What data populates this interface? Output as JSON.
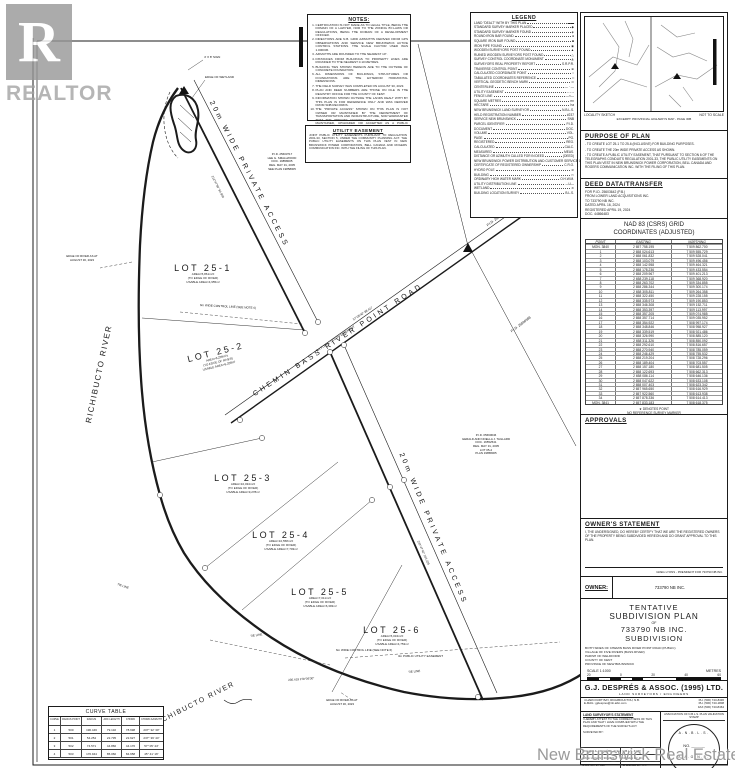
{
  "sheet": {
    "watermark_logo_letter": "R",
    "watermark_logo_text": "REALTOR",
    "watermark_board_text": "New Brunswick Real Estate Board"
  },
  "notes": {
    "title": "NOTES:",
    "items": [
      "CERTIFICATION IS NOT MADE AS TO LEGAL TITLE, BEING THE DOMAIN OF A LAWYER, NOR TO THE ZONING BY-LAWS OR REGULATIONS, BEING THE DOMAIN OF A DEVELOPMENT OFFICER.",
      "DIRECTIONS ARE N.B. GRID AZIMUTHS DERIVED FROM GPS OBSERVATIONS AND SERVICE NEW BRUNSWICK ACTIVE CONTROL STATIONS. THE SCALE FACTOR USED WAS 1.000036.",
      "AZIMUTHS ARE ROUNDED TO THE NEAREST 10\".",
      "DISTANCES FROM BUILDINGS TO PROPERTY LINES ARE ROUNDED TO THE NEAREST 0.10 METRES.",
      "BUILDING TIES SHOWN HEREON ARE TO THE OUTSIDE OF CONCRETE FOUNDATION.",
      "ALL DIMENSIONS OF BUILDINGS, STRUCTURES OR FOUNDATIONS ARE THE EXTERIOR HORIZONTAL DIMENSIONS.",
      "THE FIELD SURVEY WAS COMPLETED ON AUGUST 30, 2023.",
      "PLAN AND DEED NUMBERS ARE THOSE ON FILE IN THE REGISTRY OFFICE FOR THE COUNTY OF KENT.",
      "INFORMATION SHOWN OUTSIDE THE LANDS DEALT WITH BY THIS PLAN IS FOR REFERENCE ONLY AND WAS DERIVED FROM SNB RECORDS.",
      "THE \"PRIVATE ACCESS\" SHOWN ON THIS PLAN IS NOT OWNED OR MAINTAINED BY THE DEPARTMENT OF TRANSPORTATION AND INFRASTRUCTURE, NOR WARRANTED THAT THE \"PRIVATE ACCESS\" WILL IN THE FUTURE BE MAINTAINED, UPGRADED OR ACCEPTED AS A PUBLIC STREET.",
      "SUBJECT TO WATERCOURSE ALTERATION REGULATION 90-80 UNDER THE CLEAN WATER ACT (O.C. 90-532)."
    ]
  },
  "utility_easement": {
    "title": "UTILITY EASEMENT",
    "body": "JOINT PUBLIC UTILITY EASEMENTS PURSUANT TO REGULATION 2001-33, SECTION 5, UNDER THE COMMUNITY PLANNING ACT. THE PUBLIC UTILITY EASEMENTS ON THIS PLAN VEST IN NEW BRUNSWICK POWER CORPORATION, BELL CANADA AND ROGERS COMMUNICATION INC. WITH THE FILING OF THIS PLAN."
  },
  "legend": {
    "title": "LEGEND",
    "items": [
      {
        "label": "LAND \"DEALT\" WITH BY THIS PLAN",
        "symbol": "▬▬"
      },
      {
        "label": "STANDARD SURVEY MARKER PLACED",
        "symbol": "◆"
      },
      {
        "label": "STANDARD SURVEY MARKER FOUND",
        "symbol": "◈"
      },
      {
        "label": "ROUND IRON BAR FOUND",
        "symbol": "●"
      },
      {
        "label": "SQUARE IRON BAR FOUND",
        "symbol": "■"
      },
      {
        "label": "IRON PIPE FOUND",
        "symbol": "◉"
      },
      {
        "label": "WOODEN SURVEYORS POST FOUND",
        "symbol": "▲"
      },
      {
        "label": "RUINED WOODEN SURVEYORS POST FOUND",
        "symbol": "△"
      },
      {
        "label": "SURVEY CONTROL COORDINATE MONUMENT",
        "symbol": "◭"
      },
      {
        "label": "SURVEYOR'S REAL PROPERTY REPORT",
        "symbol": "S.R.P.R."
      },
      {
        "label": "TRAVERSE CONTROL POINT",
        "symbol": "⊕"
      },
      {
        "label": "CALCULATED COORDINATE POINT",
        "symbol": "○"
      },
      {
        "label": "TABULATED COORDINATES REFERENCE",
        "symbol": "□"
      },
      {
        "label": "VERTICAL GEODETIC BENCH MARK",
        "symbol": "⊙"
      },
      {
        "label": "CENTERLINE",
        "symbol": "— · —"
      },
      {
        "label": "UTILITY EASEMENT",
        "symbol": "– – –"
      },
      {
        "label": "FENCE LINE",
        "symbol": "—×—"
      },
      {
        "label": "SQUARE METRES",
        "symbol": "m²"
      },
      {
        "label": "HECTARE",
        "symbol": "ha"
      },
      {
        "label": "NEW BRUNSWICK LAND SURVEYOR",
        "symbol": "N.B.L.S."
      },
      {
        "label": "HELD REGISTRATION NUMBER",
        "symbol": "#237"
      },
      {
        "label": "SERVICE NEW BRUNSWICK",
        "symbol": "SNB"
      },
      {
        "label": "PARCEL IDENTIFIER",
        "symbol": "P.I.D."
      },
      {
        "label": "DOCUMENT",
        "symbol": "DOC."
      },
      {
        "label": "VOLUME",
        "symbol": "VOL."
      },
      {
        "label": "PAGE",
        "symbol": "PG."
      },
      {
        "label": "REGISTERED",
        "symbol": "REG."
      },
      {
        "label": "CALCULATED",
        "symbol": "CALC."
      },
      {
        "label": "MEASURED",
        "symbol": "MEAS."
      },
      {
        "label": "DISTANCE OR AZIMUTH CALLED FOR IN DEED",
        "symbol": "(DEED)"
      },
      {
        "label": "NEW BRUNSWICK POWER DISTRIBUTION AND CUSTOMER SERVICE CORPORATION",
        "symbol": "NB POWER"
      },
      {
        "label": "CERTIFICATE OF REGISTERED OWNERSHIP",
        "symbol": "C.R.O."
      },
      {
        "label": "HYDRO POLE",
        "symbol": "⊘"
      },
      {
        "label": "BUILDING",
        "symbol": "▭"
      },
      {
        "label": "ORDINARY HIGH WATER MARK",
        "symbol": "O.H.W.M."
      },
      {
        "label": "UTILITY DISTRIBUTION LINE",
        "symbol": "—U—"
      },
      {
        "label": "WETLAND",
        "symbol": "≋"
      },
      {
        "label": "BUILDING LOCATION SURVEY",
        "symbol": "B.L.S."
      }
    ]
  },
  "locality": {
    "caption_left": "LOCALITY SKETCH",
    "caption_right": "NOT TO SCALE",
    "caption_bottom": "EXCERPT: PROVINCIAL HIGHWAYS MAP - PAGE 30B"
  },
  "purpose": {
    "title": "PURPOSE OF PLAN",
    "items": [
      "TO CREATE LOT 25-1 TO 25-6 (INCLUSIVE) FOR BUILDING PURPOSES.",
      "TO CREATE THE 20m WIDE PRIVATE ACCESS AS SHOWN.",
      "TO CREATE A PUBLIC UTILITY EASEMENT, THAT PURSUANT TO SECTION 6 OF THE TELEGRAPHS CONDUITS REGULATION 2001-33, THE PUBLIC UTILITY EASEMENTS ON THIS PLAN VEST IN NEW BRUNSWICK POWER CORPORATION, BELL CANADA AND ROGERS COMMUNICATION INC. WITH THE FILING OF THIS PLAN."
    ]
  },
  "deed": {
    "title": "DEED DATA/TRANSFER",
    "lines": [
      "FOR P.I.D. 25603642 (P.B.)",
      "FROM LOWER LAND ACQUISITIONS INC.",
      "TO 733790 NB INC.",
      "DATED APRIL 16, 2024",
      "REGISTERED APRIL 19, 2024",
      "DOC. 44866483"
    ]
  },
  "coordinates": {
    "title1": "NAD 83 (CSRS) GRID",
    "title2": "COORDINATES (ADJUSTED)",
    "headers": [
      "POINT",
      "EASTING",
      "NORTHING"
    ],
    "rows": [
      [
        "MON. 3840",
        "2 657 758.195",
        "7 509 862.700"
      ],
      [
        "1",
        "2 658 024.613",
        "7 509 555.729"
      ],
      [
        "2",
        "2 658 061.832",
        "7 509 528.041"
      ],
      [
        "3",
        "2 658 103.079",
        "7 509 496.456"
      ],
      [
        "4",
        "2 658 142.958",
        "7 509 464.321"
      ],
      [
        "5",
        "2 658 178.236",
        "7 509 433.554"
      ],
      [
        "6",
        "2 658 209.967",
        "7 509 401.213"
      ],
      [
        "7",
        "2 658 239.118",
        "7 509 368.920"
      ],
      [
        "8",
        "2 658 263.702",
        "7 509 334.855"
      ],
      [
        "9",
        "2 658 286.344",
        "7 509 300.174"
      ],
      [
        "10",
        "2 658 305.811",
        "7 509 264.358"
      ],
      [
        "11",
        "2 658 322.450",
        "7 509 228.155"
      ],
      [
        "12",
        "2 658 335.973",
        "7 509 190.853"
      ],
      [
        "13",
        "2 658 346.308",
        "7 509 152.711"
      ],
      [
        "14",
        "2 658 353.397",
        "7 509 113.997"
      ],
      [
        "15",
        "2 658 357.205",
        "7 509 074.985"
      ],
      [
        "16",
        "2 658 357.714",
        "7 509 035.952"
      ],
      [
        "17",
        "2 658 354.922",
        "7 508 997.174"
      ],
      [
        "18",
        "2 658 348.846",
        "7 508 958.927"
      ],
      [
        "19",
        "2 658 339.519",
        "7 508 921.486"
      ],
      [
        "20",
        "2 658 326.990",
        "7 508 885.120"
      ],
      [
        "21",
        "2 658 311.326",
        "7 508 850.092"
      ],
      [
        "22",
        "2 658 292.610",
        "7 508 816.657"
      ],
      [
        "23",
        "2 658 270.940",
        "7 508 785.059"
      ],
      [
        "24",
        "2 658 246.429",
        "7 508 755.532"
      ],
      [
        "25",
        "2 658 219.204",
        "7 508 728.296"
      ],
      [
        "26",
        "2 658 189.404",
        "7 508 703.557"
      ],
      [
        "27",
        "2 658 157.180",
        "7 508 681.505"
      ],
      [
        "28",
        "2 658 122.693",
        "7 508 662.313"
      ],
      [
        "29",
        "2 658 086.114",
        "7 508 646.136"
      ],
      [
        "30",
        "2 658 047.622",
        "7 508 633.108"
      ],
      [
        "31",
        "2 658 007.403",
        "7 508 623.342"
      ],
      [
        "32",
        "2 657 965.650",
        "7 508 616.929"
      ],
      [
        "33",
        "2 657 922.560",
        "7 508 613.938"
      ],
      [
        "34",
        "2 657 878.336",
        "7 508 614.413"
      ],
      [
        "MON. 3841",
        "2 657 833.183",
        "7 508 618.375"
      ]
    ],
    "footnote1": "★ DENOTES POINT",
    "footnote2": "NO REFERENCE SURVEY MARKER"
  },
  "approvals": {
    "title": "APPROVALS"
  },
  "owner_statement": {
    "title": "OWNER'S STATEMENT",
    "body": "I, THE UNDERSIGNED, DO HEREBY CERTIFY THAT WE ARE THE REGISTERED OWNERS OF THE PROPERTY BEING SUBDIVIDED HEREON AND DO GRANT APPROVAL TO THIS PLAN.",
    "signature_caption": "GREG LYONS - PRESIDENT FOR 733790 NB INC."
  },
  "owner": {
    "label": "OWNER:",
    "value": "733790 NB INC."
  },
  "title_block": {
    "t1": "TENTATIVE",
    "t2": "SUBDIVISION PLAN",
    "t_of": "OF",
    "t4": "733790 NB INC.",
    "t5": "SUBDIVISION",
    "location": [
      "BOTH SIDES OF CHEMIN BASS RIVER POINT ROAD (PUBLIC)",
      "VILLAGE OF FIVE RIVERS (BASS RIVER)",
      "PARISH OF WELDFORD",
      "COUNTY OF KENT",
      "PROVINCE OF NEW BRUNSWICK"
    ],
    "scale_label": "SCALE  1:1000",
    "units_label": "METRES",
    "ticks": [
      "20",
      "0",
      "20",
      "40",
      "60"
    ]
  },
  "firm": {
    "name": "G.J. DESPRÉS & ASSOC. (1995) LTD.",
    "subtitle": "LAND SURVEYORS / ENGINEERS",
    "address1": "4 HARCOURT BAY, RICHIBOUCTOU, N.B.",
    "address2": "E-MAIL: gjdespres@nb.aibn.com",
    "phone1": "PH. (506) 743-8436",
    "phone2": "PH. (506) 743-1808",
    "phone3": "FAX (506) 743-8464",
    "statement_title": "LAND SURVEYOR'S STATEMENT",
    "statement_body": "I HEREBY ATTEST TO THE CORRECTNESS OF THIS PLAN AND THAT I HAVE COMPLIED WITH THE REQUIREMENTS OF THE SURVEYS ACT.",
    "surveyed_by": "SURVEYED BY:",
    "surveyor": "ROLAND A. FOUGÈRE, P. Eng.",
    "surveyor_reg": "N.B.L.S. # 370",
    "f1l": "DATE:",
    "f1v": "AUGUST 30, 2024",
    "f2l": "DRAWN BY:",
    "f2v": "L.G.",
    "f3l": "DWG No.:",
    "f3v": "24-105",
    "f4l": "CHECKED BY:",
    "f4v": "R.F.",
    "stamp_title": "ASSOCIATION OF N.B.L.S. PLAN VALIDATION STAMP",
    "stamp_top": "A.N.B.L.S.",
    "stamp_no": "NO. ______",
    "stamp_bottom": "A.A.G.N.B."
  },
  "curve_table": {
    "title": "CURVE TABLE",
    "headers": [
      "CURVE",
      "RADIUS POINT",
      "RADIUS",
      "ARC LENGTH",
      "CHORD",
      "CHORD AZIMUTH"
    ],
    "rows": [
      [
        "1",
        "500",
        "196.446",
        "79.132",
        "78.698",
        "207° 32' 30\""
      ],
      [
        "2",
        "501",
        "54.254",
        "22.735",
        "22.627",
        "237° 39' 44\""
      ],
      [
        "3",
        "502",
        "74.571",
        "44.866",
        "44.176",
        "57° 05' 44\""
      ],
      [
        "4",
        "503",
        "176.944",
        "85.060",
        "84.658",
        "45° 41' 16\""
      ]
    ]
  },
  "drawing": {
    "road_access_upper": "20m WIDE PRIVATE ACCESS",
    "road_chemin": "CHEMIN BASS RIVER POINT ROAD",
    "road_access_lower": "20m WIDE PRIVATE ACCESS",
    "river_left": "RICHIBUCTO RIVER",
    "river_bottom": "RICHIBUCTO RIVER",
    "wetland_label": "EDGE OF WETLAND",
    "sign_label": "4' X 8' SIGN",
    "river_note1a": "EDGE OF RIVER AS AT",
    "river_note1b": "AUGUST 30, 2023",
    "river_note2a": "EDGE OF RIVER AS AT",
    "river_note2b": "AUGUST 30, 2023",
    "control_upper": "6m WIDE CONTROL LINE (SEE NOTE 6)",
    "control_lower": "6m WIDE CONTROL LINE (SEE NOTE 6)",
    "easement_road": "3m PUBLIC UTILITY EASEMENT",
    "easement_lower": "3m PUBLIC UTILITY EASEMENT",
    "pid1": [
      "P.I.D. 25603717",
      "LEE G. SMALLWOOD",
      "DOC. 19858005",
      "REG. MAY 31, 2005",
      "SEE PLAN 19858005"
    ],
    "pid_road_1": "P.I.D. 25560370",
    "pid_road_2": "P.I.D. 25560388",
    "pid2": [
      "P.I.D. 05660646",
      "GERALD AND NOELLA J. TAILLARD",
      "DOC. 16552541",
      "REG. MAY 31, 2005",
      "LOT 05-2",
      "PLAN 19858005"
    ],
    "lots": [
      {
        "name": "LOT 25-1",
        "area": "AREA=5,861m²±",
        "note": "(TO EDGE OF RIVER)",
        "usable": "USABLE AREA=4,955m²"
      },
      {
        "name": "LOT 25-2",
        "area": "AREA=6,209m²±",
        "note": "(TO EDGE OF RIVER)",
        "usable": "USABLE AREA=5,208m²"
      },
      {
        "name": "LOT 25-3",
        "area": "AREA=10,034m²±",
        "note": "(TO EDGE OF RIVER)",
        "usable": "USABLE AREA=9,278m²"
      },
      {
        "name": "LOT 25-4",
        "area": "AREA=10,558m²±",
        "note": "(TO EDGE OF RIVER)",
        "usable": "USABLE AREA=7,703m²"
      },
      {
        "name": "LOT 25-5",
        "area": "AREA=7,011m²±",
        "note": "(TO EDGE OF RIVER)",
        "usable": "USABLE AREA=6,393m²"
      },
      {
        "name": "LOT 25-6",
        "area": "AREA=5,034m²±",
        "note": "(TO EDGE OF RIVER)",
        "usable": "USABLE AREA=4,753m²"
      }
    ],
    "dims": [
      {
        "t": "212°47'30\"  94.966"
      },
      {
        "t": "57°05'40\"  88.417"
      },
      {
        "t": "242°47'40\"  163.225"
      },
      {
        "t": "TIE LINE"
      },
      {
        "t": "TIE LINE"
      },
      {
        "t": "TIE LINE"
      },
      {
        "t": "236.419  278°36'30\""
      }
    ]
  }
}
